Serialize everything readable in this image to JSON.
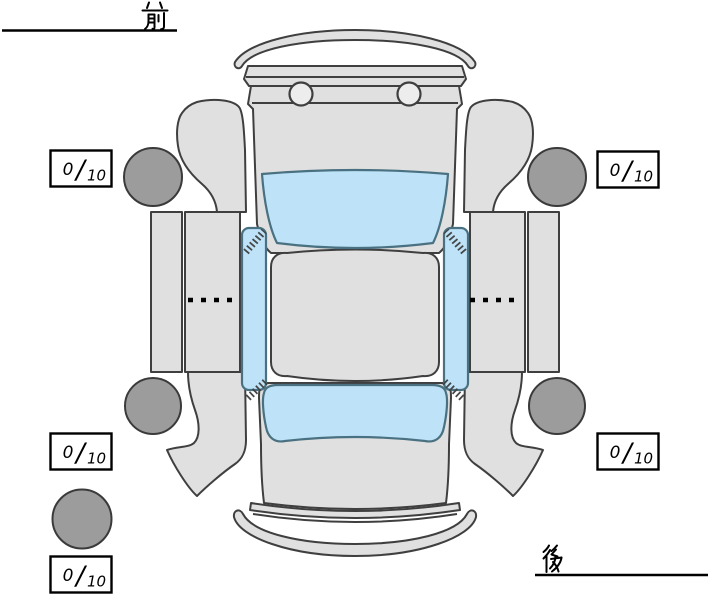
{
  "labels": {
    "front": "前",
    "rear": "後"
  },
  "scores": {
    "front_left": {
      "value": "0",
      "separator": "/",
      "max": "10"
    },
    "front_right": {
      "value": "0",
      "separator": "/",
      "max": "10"
    },
    "rear_left": {
      "value": "0",
      "separator": "/",
      "max": "10"
    },
    "rear_right": {
      "value": "0",
      "separator": "/",
      "max": "10"
    },
    "spare": {
      "value": "0",
      "separator": "/",
      "max": "10"
    }
  },
  "diagram": {
    "description": "car-top-view-exterior-condition-diagram",
    "orientation": {
      "front_label_position": "top-left",
      "rear_label_position": "bottom-right"
    },
    "tires": [
      "front-left",
      "front-right",
      "rear-left",
      "rear-right",
      "spare"
    ],
    "colors": {
      "body": "#e0e0e0",
      "glass": "#bee3f8",
      "tire": "#9c9c9c",
      "outline": "#3f3f3f"
    }
  }
}
